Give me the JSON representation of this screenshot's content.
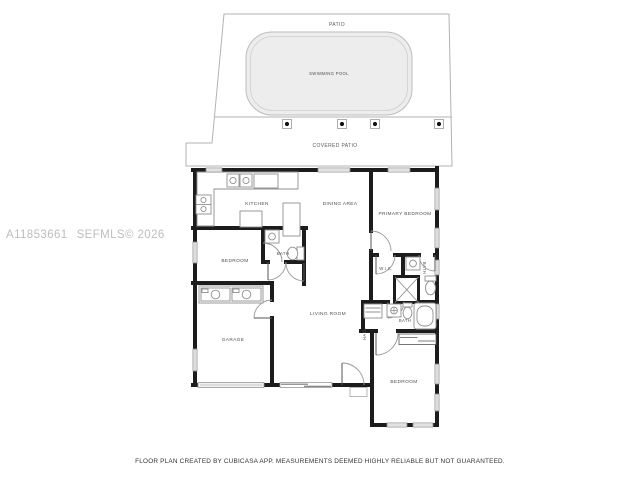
{
  "watermark": {
    "listing_id": "A11853661",
    "mls_tag": "SEFMLS© 2026"
  },
  "site": {
    "patio": "PATIO",
    "swimming_pool": "SWIMMING POOL",
    "covered_patio": "COVERED PATIO"
  },
  "rooms": {
    "kitchen": "KITCHEN",
    "dining_area": "DINING AREA",
    "primary_bedroom": "PRIMARY BEDROOM",
    "bedroom_left": "BEDROOM",
    "bath_ensuite": "BATH",
    "wic": "W.I.C.",
    "bath_primary": "BATH",
    "bath_hall": "BATH",
    "hall": "HALL",
    "living_room": "LIVING ROOM",
    "garage": "GARAGE",
    "bedroom_right": "BEDROOM"
  },
  "footer": {
    "disclaimer": "FLOOR PLAN CREATED BY CUBICASA APP. MEASUREMENTS DEEMED HIGHLY RELIABLE BUT NOT GUARANTEED."
  },
  "colors": {
    "wall": "#1c1c1c",
    "fixture_line": "#8f8f8f",
    "lot_line": "#b3b3b3",
    "pool_fill": "#ededed",
    "watermark_gray": "#bdbdbd"
  }
}
